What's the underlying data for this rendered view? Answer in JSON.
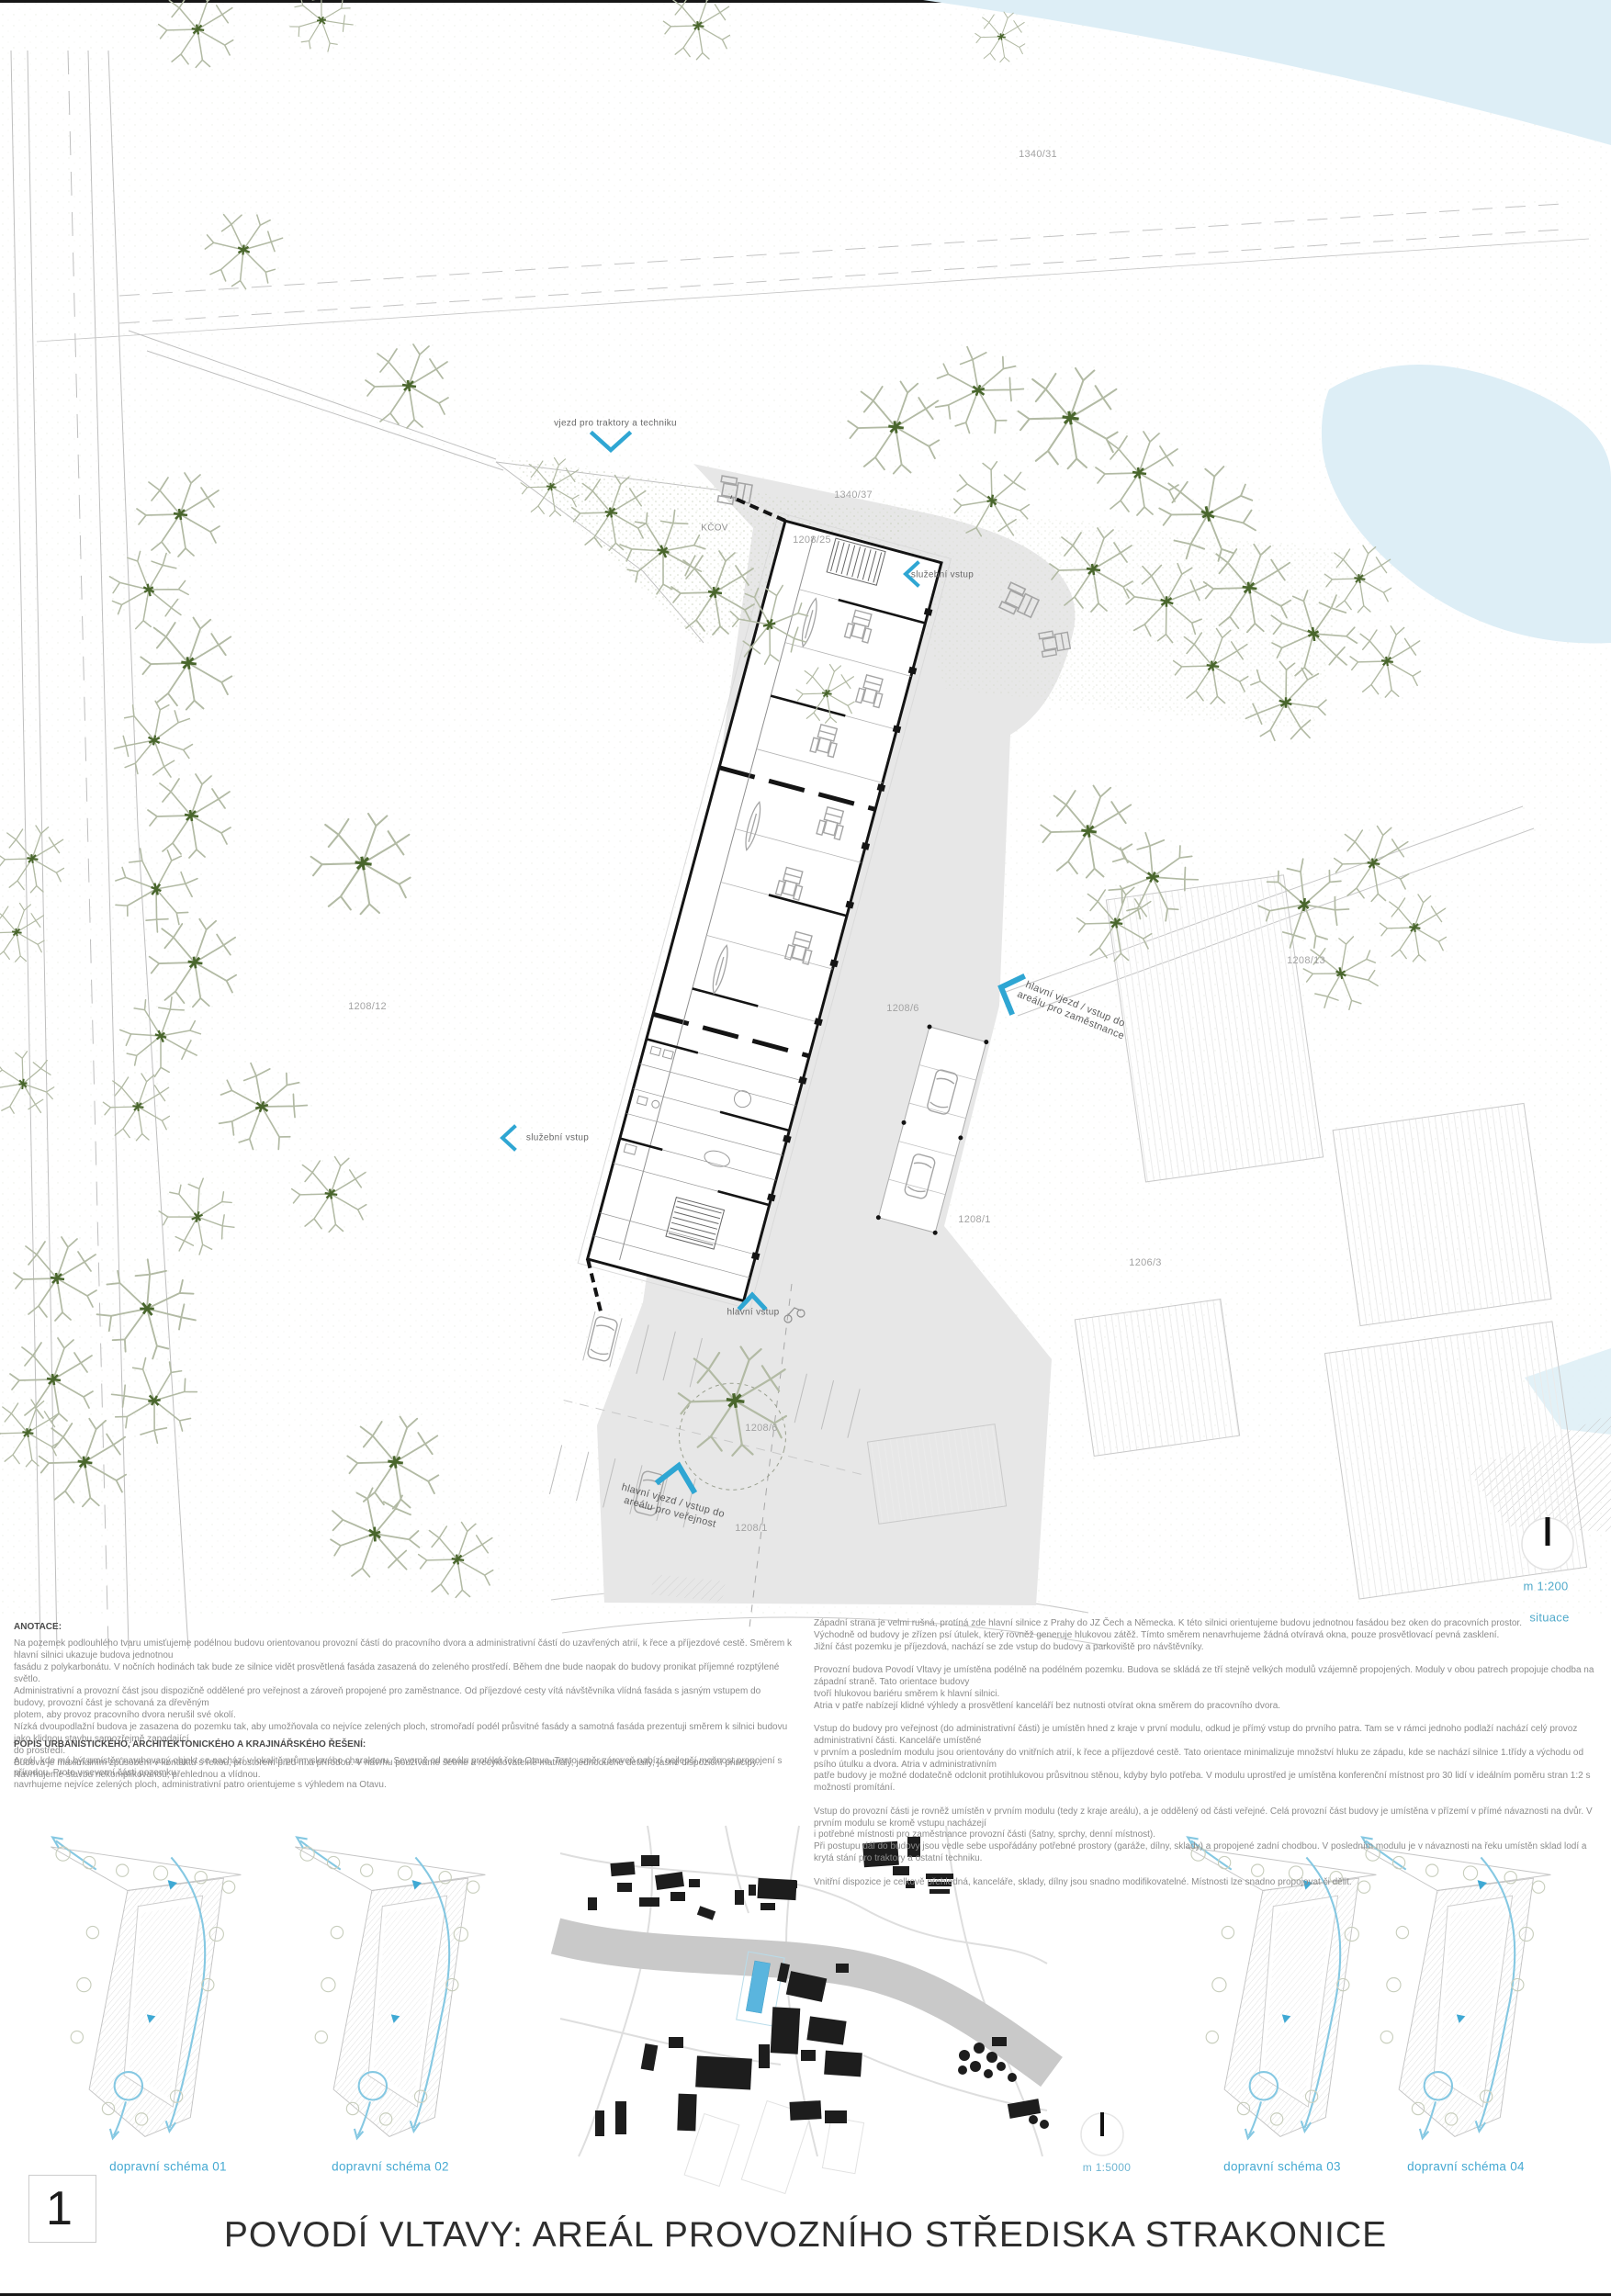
{
  "page": {
    "number": "1",
    "title": "POVODÍ VLTAVY: AREÁL PROVOZNÍHO STŘEDISKA STRAKONICE"
  },
  "colors": {
    "accent_blue": "#2fa6d3",
    "label_blue": "#51aacb",
    "water": "#ddeef6",
    "pavement": "#e7e7e7"
  },
  "site": {
    "parcels": {
      "p1340_31": "1340/31",
      "p1340_37": "1340/37",
      "p1208_25": "1208/25",
      "p1208_12": "1208/12",
      "p1208_6a": "1208/6",
      "p1208_13": "1208/13",
      "p1208_1a": "1208/1",
      "p1206_3": "1206/3",
      "p1208_6b": "1208/6",
      "p1208_1b": "1208/1"
    },
    "kcov": "KČOV",
    "entries": {
      "tractors": "vjezd pro traktory a techniku",
      "service_top": "služební vstup",
      "service_mid": "služební vstup",
      "main_entry": "hlavní vstup",
      "staff_line1": "hlavní vjezd / vstup do",
      "staff_line2": "areálu pro zaměstnance",
      "public_line1": "hlavní vjezd / vstup do",
      "public_line2": "areálu pro veřejnost"
    },
    "scale_label": "m 1:200",
    "sheet_name": "situace"
  },
  "map": {
    "scale_label": "m 1:5000"
  },
  "schemes": {
    "labels": [
      "dopravní schéma 01",
      "dopravní schéma 02",
      "dopravní schéma 03",
      "dopravní schéma 04"
    ]
  },
  "texts": {
    "anotace_title": "ANOTACE:",
    "anotace": "Na pozemek podlouhlého tvaru umisťujeme podélnou budovu orientovanou provozní částí do pracovního dvora a administrativní částí do uzavřených atrií, k řece a příjezdové cestě. Směrem k hlavní silnici ukazuje budova jednotnou\nfasádu z polykarbonátu. V nočních hodinách tak bude ze silnice vidět prosvětlená fasáda zasazená do zeleného prostředí. Během dne bude naopak do budovy pronikat příjemné rozptýlené světlo.\nAdministrativní a provozní část jsou dispozičně oddělené pro veřejnost a zároveň propojené pro zaměstnance. Od příjezdové cesty vítá návštěvníka vlídná fasáda s jasným vstupem do budovy, provozní část je schovaná za dřevěným\nplotem, aby provoz pracovního dvora nerušil své okolí.\nNízká dvoupodlažní budova je zasazena do pozemku tak, aby umožňovala co nejvíce zelených ploch, stromořadí podél průsvitné fasády a samotná fasáda prezentuji směrem k silnici budovu jako klidnou stavbu samozřejmě zapadající\ndo prostředí.\nBudova je maximálním způsobem v kontaktu s řekou, prostorem před ní a přírodou. V návrhu používáme šetrné a recyklovatelné matriály, jednoduché detaily, jasné dispoziční principy.\nNavrhujeme stavbu nekomplikovanou, přehlednou a vlídnou.",
    "popis_title": "POPIS URBANISTICKÉHO, ARCHITEKTONICKÉHO A KRAJINÁŘSKÉHO ŘEŠENÍ:",
    "popis": "Areál, kde má být umístěn navrhovaný objekt se nachází v lokalitě průmyslového charakteru. Severně od areálu protéká řeka Otava. Tento směr zároveň nabízí nejlepší možnost propojení s přírodou. Proto v severní části pozemku\nnavrhujeme nejvíce zelených ploch, administrativní patro orientujeme s výhledem na Otavu.",
    "right_col": "Západní strana je velmi rušná, protíná zde hlavní silnice z Prahy do JZ Čech a Německa. K této silnici orientujeme budovu jednotnou fasádou bez oken do pracovních prostor.\nVýchodně od budovy je zřízen psí útulek, který rovněž generuje hlukovou zátěž. Tímto směrem nenavrhujeme žádná otvíravá okna, pouze prosvětlovací pevná zasklení.\nJižní část pozemku je příjezdová, nachází se zde vstup do budovy a parkoviště pro návštěvníky.\n\nProvozní budova Povodí Vltavy je umístěna podélně na podélném pozemku. Budova se skládá ze tří stejně velkých modulů vzájemně propojených. Moduly v obou patrech propojuje chodba na západní straně. Tato orientace budovy\ntvoří hlukovou bariéru směrem k hlavní silnici.\nAtria v patře nabízejí klidné výhledy a prosvětlení kanceláří bez nutnosti otvírat okna směrem do pracovního dvora.\n\nVstup do budovy pro veřejnost (do administrativní části) je umístěn hned z kraje v první modulu, odkud je přímý vstup do prvního patra. Tam se v rámci jednoho podlaží nachází celý provoz administrativní části. Kanceláře umístěné\nv prvním a posledním modulu jsou orientovány do vnitřních atrií, k řece a příjezdové cestě. Tato orientace minimalizuje množství hluku ze západu, kde se nachází silnice 1.třídy a východu od psího útulku a dvora. Atria v administrativním\npatře budovy je možné dodatečně odclonit protihlukovou průsvitnou stěnou, kdyby bylo potřeba. V modulu uprostřed je umístěna konferenční místnost pro 30 lidí v ideálním poměru stran 1:2 s možností promítání.\n\nVstup do provozní části je rovněž umístěn v prvním modulu (tedy z kraje areálu), a je oddělený od části veřejné. Celá provozní část budovy je umístěna v přízemí v přímé návaznosti na dvůr. V prvním modulu se kromě vstupu nacházejí\ni potřebné místnosti pro zaměstnance provozní části (šatny, sprchy, denní místnost).\nPři postupu dál do budovy jsou vedle sebe uspořádány potřebné prostory (garáže, dílny, sklady) a propojené zadní chodbou. V posledním modulu je v návaznosti na řeku umístěn sklad lodí a krytá stání pro traktory a ostatní techniku.\n\nVnitřní dispozice je celkově přehledná, kanceláře, sklady, dílny jsou snadno modifikovatelné. Místnosti lze snadno propojovat či dělit."
  }
}
